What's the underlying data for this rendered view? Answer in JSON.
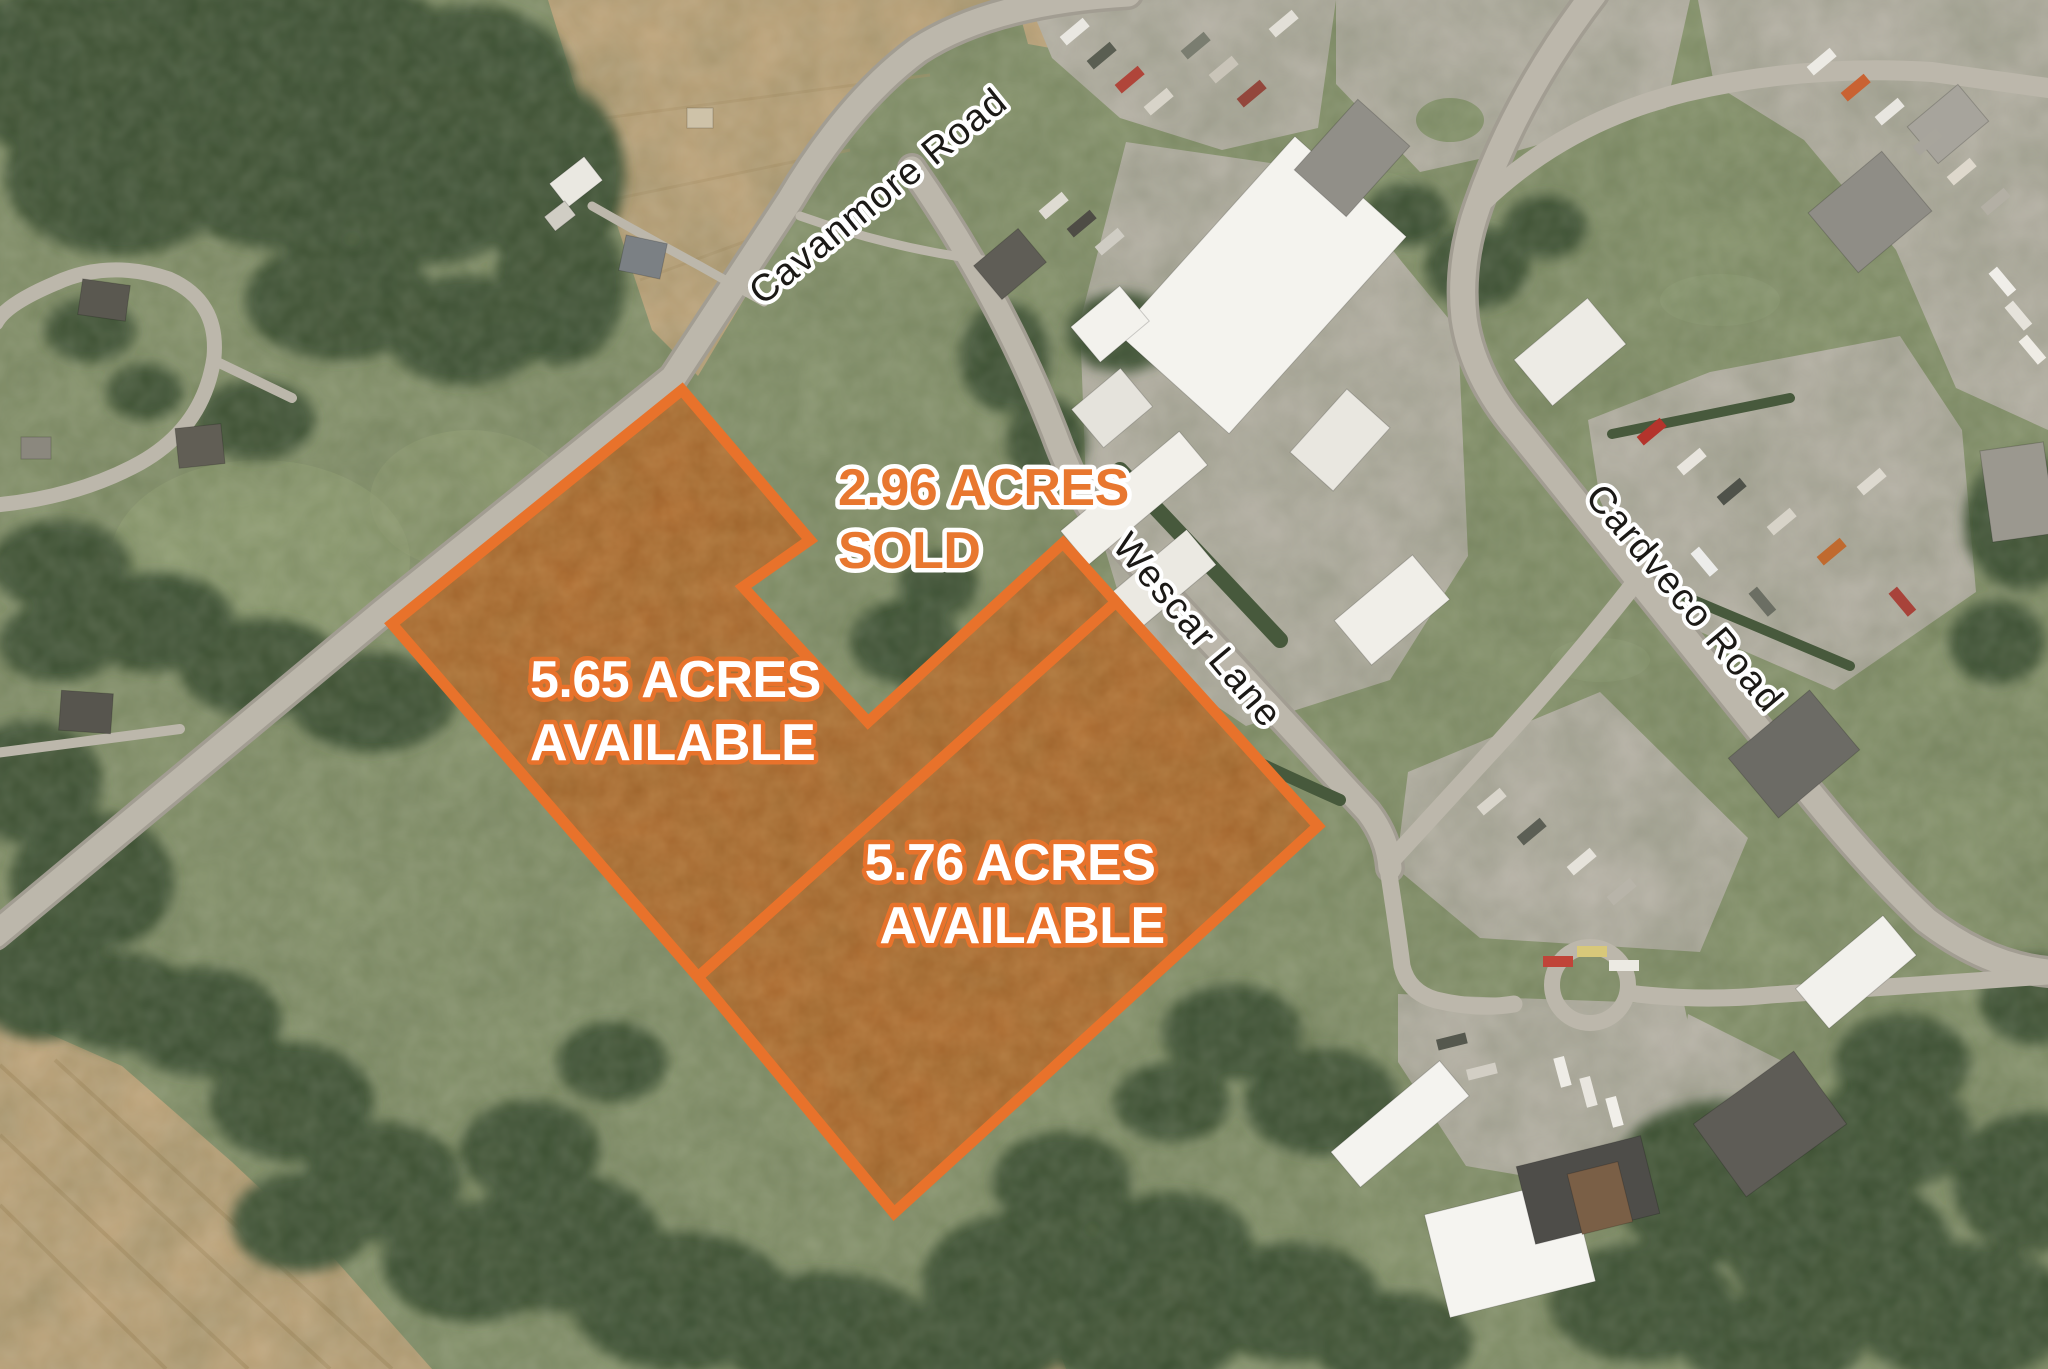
{
  "theme": {
    "accent_orange": "#E8722B",
    "label_orange": "#E8772F",
    "label_white": "#FFFFFF",
    "road_label_color": "#1B1916"
  },
  "roads": [
    {
      "name": "Cavanmore Road"
    },
    {
      "name": "Wescar Lane"
    },
    {
      "name": "Cardveco Road"
    }
  ],
  "parcels": [
    {
      "id": "parcel-2-96",
      "acres": 2.96,
      "status": "SOLD",
      "line1": "2.96 ACRES",
      "line2": "SOLD",
      "outlined": false,
      "points": ""
    },
    {
      "id": "parcel-5-65",
      "acres": 5.65,
      "status": "AVAILABLE",
      "line1": "5.65 ACRES",
      "line2": "AVAILABLE",
      "outlined": true,
      "points": "682,390 810,540 743,587 868,722 1063,543 1116,602 698,977 392,624"
    },
    {
      "id": "parcel-5-76",
      "acres": 5.76,
      "status": "AVAILABLE",
      "line1": "5.76 ACRES",
      "line2": "AVAILABLE",
      "outlined": true,
      "points": "1116,602 1318,826 894,1213 698,977"
    }
  ]
}
